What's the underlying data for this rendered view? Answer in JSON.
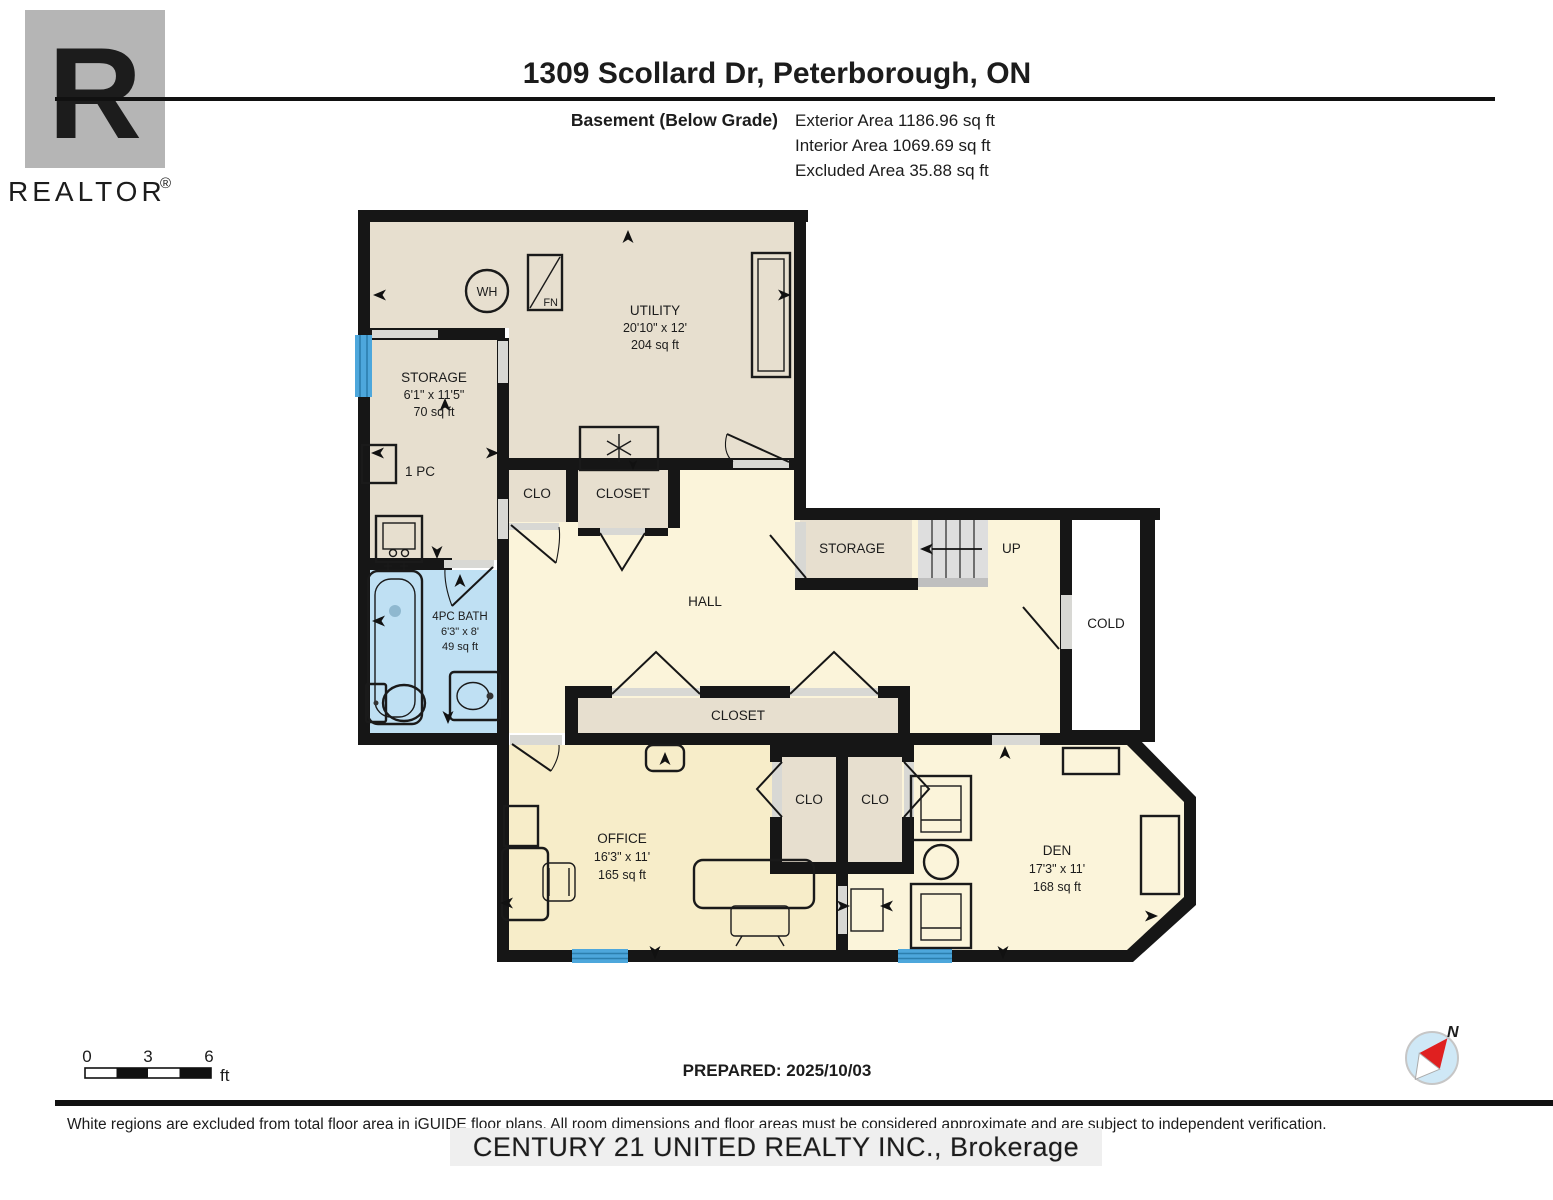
{
  "header": {
    "title": "1309 Scollard Dr, Peterborough, ON",
    "floor_label": "Basement (Below Grade)",
    "exterior_area": "Exterior Area 1186.96 sq ft",
    "interior_area": "Interior Area 1069.69 sq ft",
    "excluded_area": "Excluded Area 35.88 sq ft"
  },
  "logo": {
    "letter": "R",
    "brand": "REALTOR",
    "registered": "®"
  },
  "rooms": {
    "utility": {
      "name": "UTILITY",
      "dims": "20'10\" x 12'",
      "area": "204 sq ft"
    },
    "storage_left": {
      "name": "STORAGE",
      "dims": "6'1\" x 11'5\"",
      "area": "70 sq ft"
    },
    "one_pc": {
      "name": "1 PC"
    },
    "bath": {
      "name": "4PC BATH",
      "dims": "6'3\" x 8'",
      "area": "49 sq ft"
    },
    "hall": {
      "name": "HALL"
    },
    "clo_hall": {
      "name": "CLO"
    },
    "closet_hall_top": {
      "name": "CLOSET"
    },
    "storage_mid": {
      "name": "STORAGE"
    },
    "stairs_up": {
      "label": "UP"
    },
    "cold": {
      "name": "COLD"
    },
    "closet_hall_bottom": {
      "name": "CLOSET"
    },
    "office": {
      "name": "OFFICE",
      "dims": "16'3\" x 11'",
      "area": "165 sq ft"
    },
    "clo_office": {
      "name": "CLO"
    },
    "clo_den": {
      "name": "CLO"
    },
    "den": {
      "name": "DEN",
      "dims": "17'3\" x 11'",
      "area": "168 sq ft"
    }
  },
  "equipment": {
    "water_heater": "WH",
    "furnace": "FN"
  },
  "scale_bar": {
    "t0": "0",
    "t3": "3",
    "t6": "6",
    "unit": "ft"
  },
  "compass": {
    "north": "N"
  },
  "footer": {
    "prepared": "PREPARED: 2025/10/03",
    "disclaimer": "White regions are excluded from total floor area in iGUIDE floor plans. All room dimensions and floor areas must be considered approximate and are subject to independent verification.",
    "watermark": "CENTURY 21 UNITED REALTY INC., Brokerage"
  },
  "colors": {
    "wall": "#161616",
    "room_tan": "#e7dfcf",
    "room_cream": "#fbf4da",
    "room_office_yellow": "#f7edc9",
    "bath_blue": "#bfe0f3",
    "cold_white": "#ffffff",
    "window_blue": "#4da7dc",
    "door_gray": "#d8d8d4",
    "stair_gray": "#dedede",
    "logo_gray": "#b5b5b5",
    "compass_blue": "#cfe8f6",
    "compass_red": "#e02020"
  }
}
